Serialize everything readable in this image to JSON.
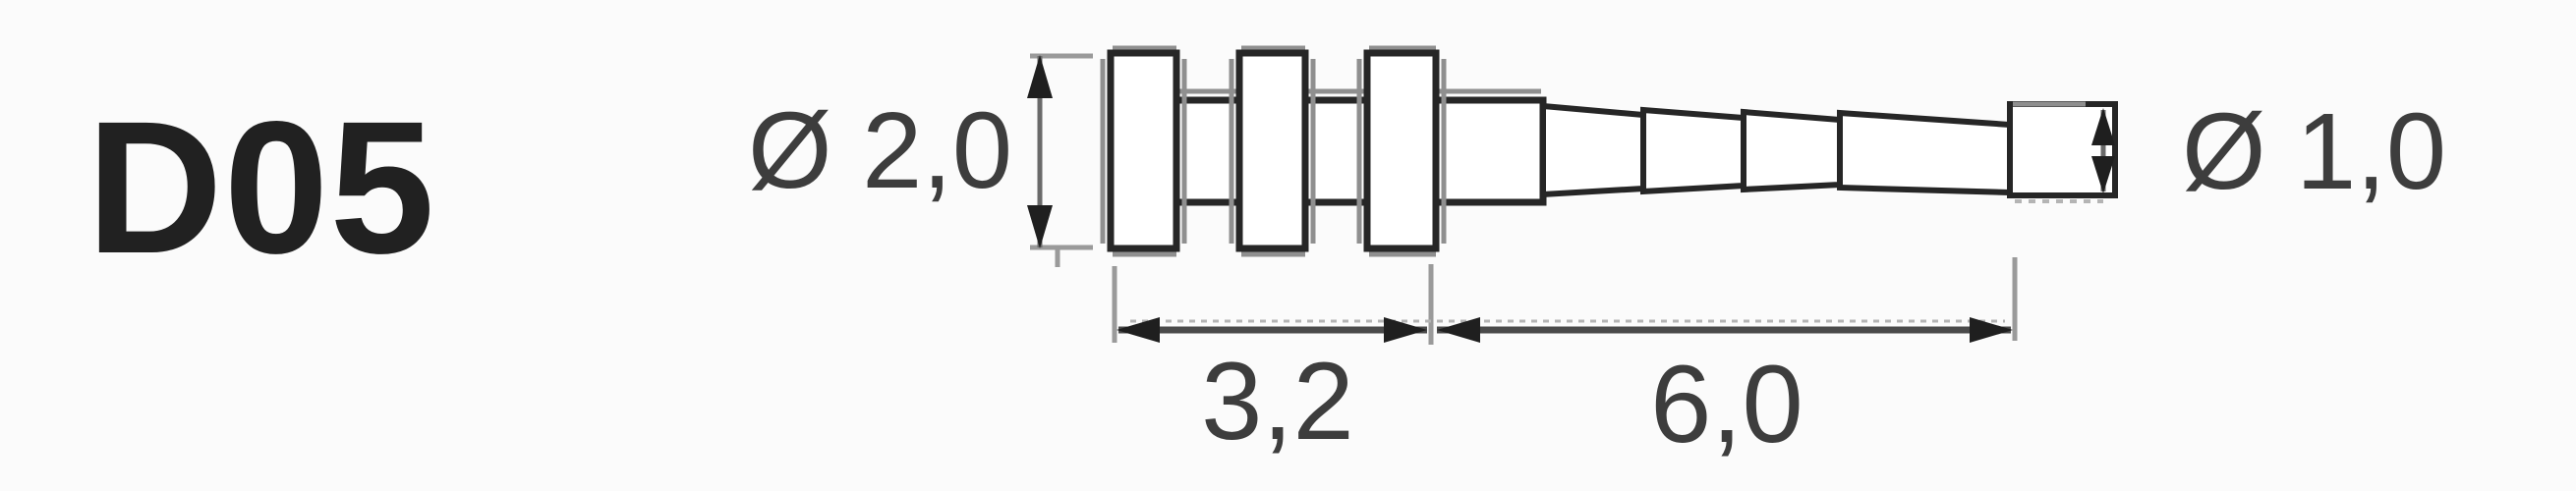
{
  "part": {
    "code": "D05"
  },
  "dimensions": {
    "diameter_left": {
      "label": "Ø 2,0",
      "value_mm": "2,0"
    },
    "diameter_right": {
      "label": "Ø 1,0",
      "value_mm": "1,0"
    },
    "length_flanged": {
      "label": "3,2",
      "value_mm": "3,2"
    },
    "length_tapered": {
      "label": "6,0",
      "value_mm": "6,0"
    }
  },
  "colors": {
    "outline": "#262626",
    "secondary_gray": "#8f8f8f",
    "dimension_line": "#4a4a4a",
    "text": "#3d3d3d",
    "part_code_text": "#212121",
    "background": "#fbfbfb"
  }
}
